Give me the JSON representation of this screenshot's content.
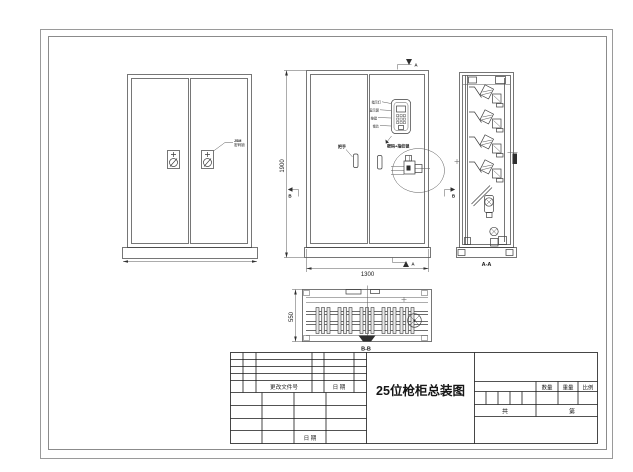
{
  "title_block": {
    "main_title": "25位枪柜总装图",
    "revision": {
      "change_file_no": "更改文件号",
      "date": "日 期"
    },
    "signature": {
      "date": "日 期"
    },
    "qty": "数量",
    "weight": "重量",
    "scale": "比例",
    "total": "共",
    "sheet": "第"
  },
  "views": {
    "front": {
      "lock_label_l1": "JSM",
      "lock_label_l2": "密码锁"
    },
    "assembly": {
      "dim_height": "1900",
      "dim_width": "1300",
      "marker_a": "A",
      "marker_b": "B",
      "handle_label": "把手",
      "lock_label": "密码+指纹锁",
      "keypad_labels": [
        "指示灯",
        "显示屏",
        "按键",
        "锁芯"
      ]
    },
    "section_a": {
      "label": "A-A"
    },
    "section_b": {
      "label": "B-B",
      "dim_depth": "550"
    }
  }
}
